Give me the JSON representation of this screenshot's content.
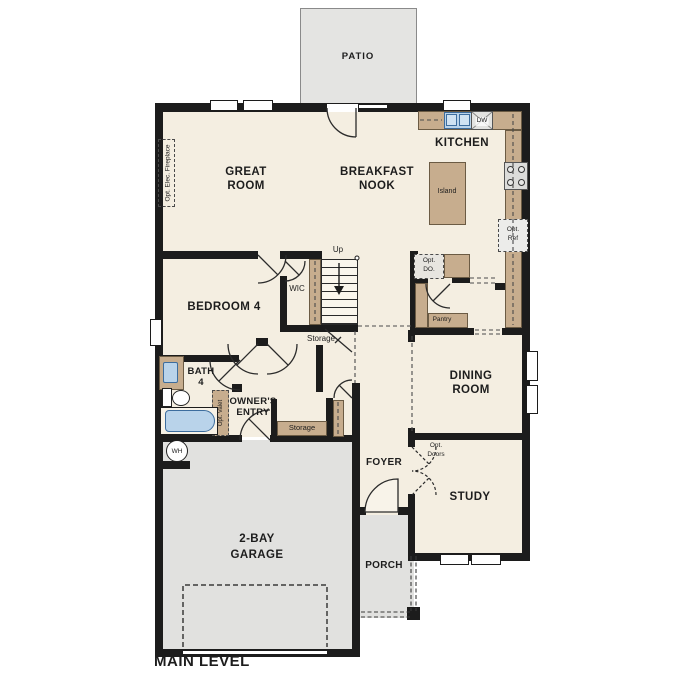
{
  "plan_title": "MAIN LEVEL",
  "labels": {
    "patio": "PATIO",
    "great_room": [
      "GREAT",
      "ROOM"
    ],
    "breakfast_nook": [
      "BREAKFAST",
      "NOOK"
    ],
    "kitchen": "KITCHEN",
    "bedroom4": "BEDROOM 4",
    "wic": "WIC",
    "up": "Up",
    "storage_under_stairs": "Storage",
    "bath4": [
      "BATH",
      "4"
    ],
    "owners_entry": [
      "OWNER'S",
      "ENTRY"
    ],
    "storage_closet": "Storage",
    "pantry": "Pantry",
    "island": "Island",
    "dining_room": [
      "DINING",
      "ROOM"
    ],
    "study": "STUDY",
    "foyer": "FOYER",
    "garage": [
      "2-BAY",
      "GARAGE"
    ],
    "porch": "PORCH",
    "dw": "DW",
    "wh": "WH",
    "opt_ref": [
      "Opt.",
      "Ref"
    ],
    "opt_do": [
      "Opt.",
      "DO."
    ],
    "opt_doors": [
      "Opt.",
      "Doors"
    ],
    "opt_elec_fireplace": "Opt. Elec. Fireplace",
    "opt_valet": "Opt. Valet"
  },
  "colors": {
    "floor": "#f4eee1",
    "hardscape_grey": "#e1e1df",
    "counter_tan": "#c7ad8e",
    "fixture_blue": "#b9d3ea",
    "wall_black": "#1c1c1c"
  }
}
